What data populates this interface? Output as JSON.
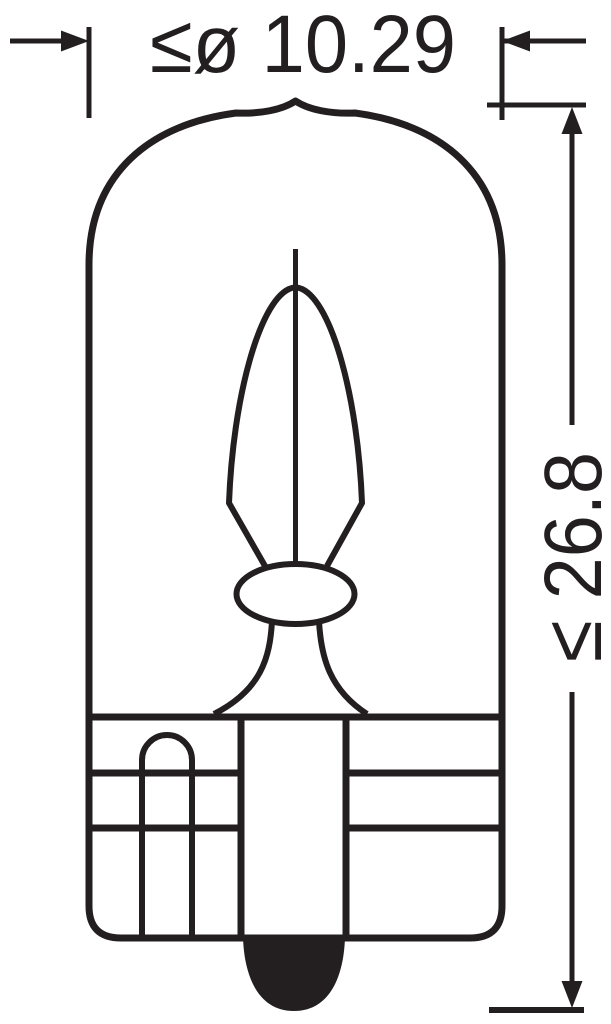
{
  "drawing": {
    "subject": "wedge-base miniature lamp side view technical drawing",
    "dimensions": {
      "diameter_label": "≤ø 10.29",
      "length_label": "≤ 26.8"
    },
    "colors": {
      "line": "#231f20",
      "background": "#ffffff",
      "tip_fill": "#231f20"
    }
  }
}
